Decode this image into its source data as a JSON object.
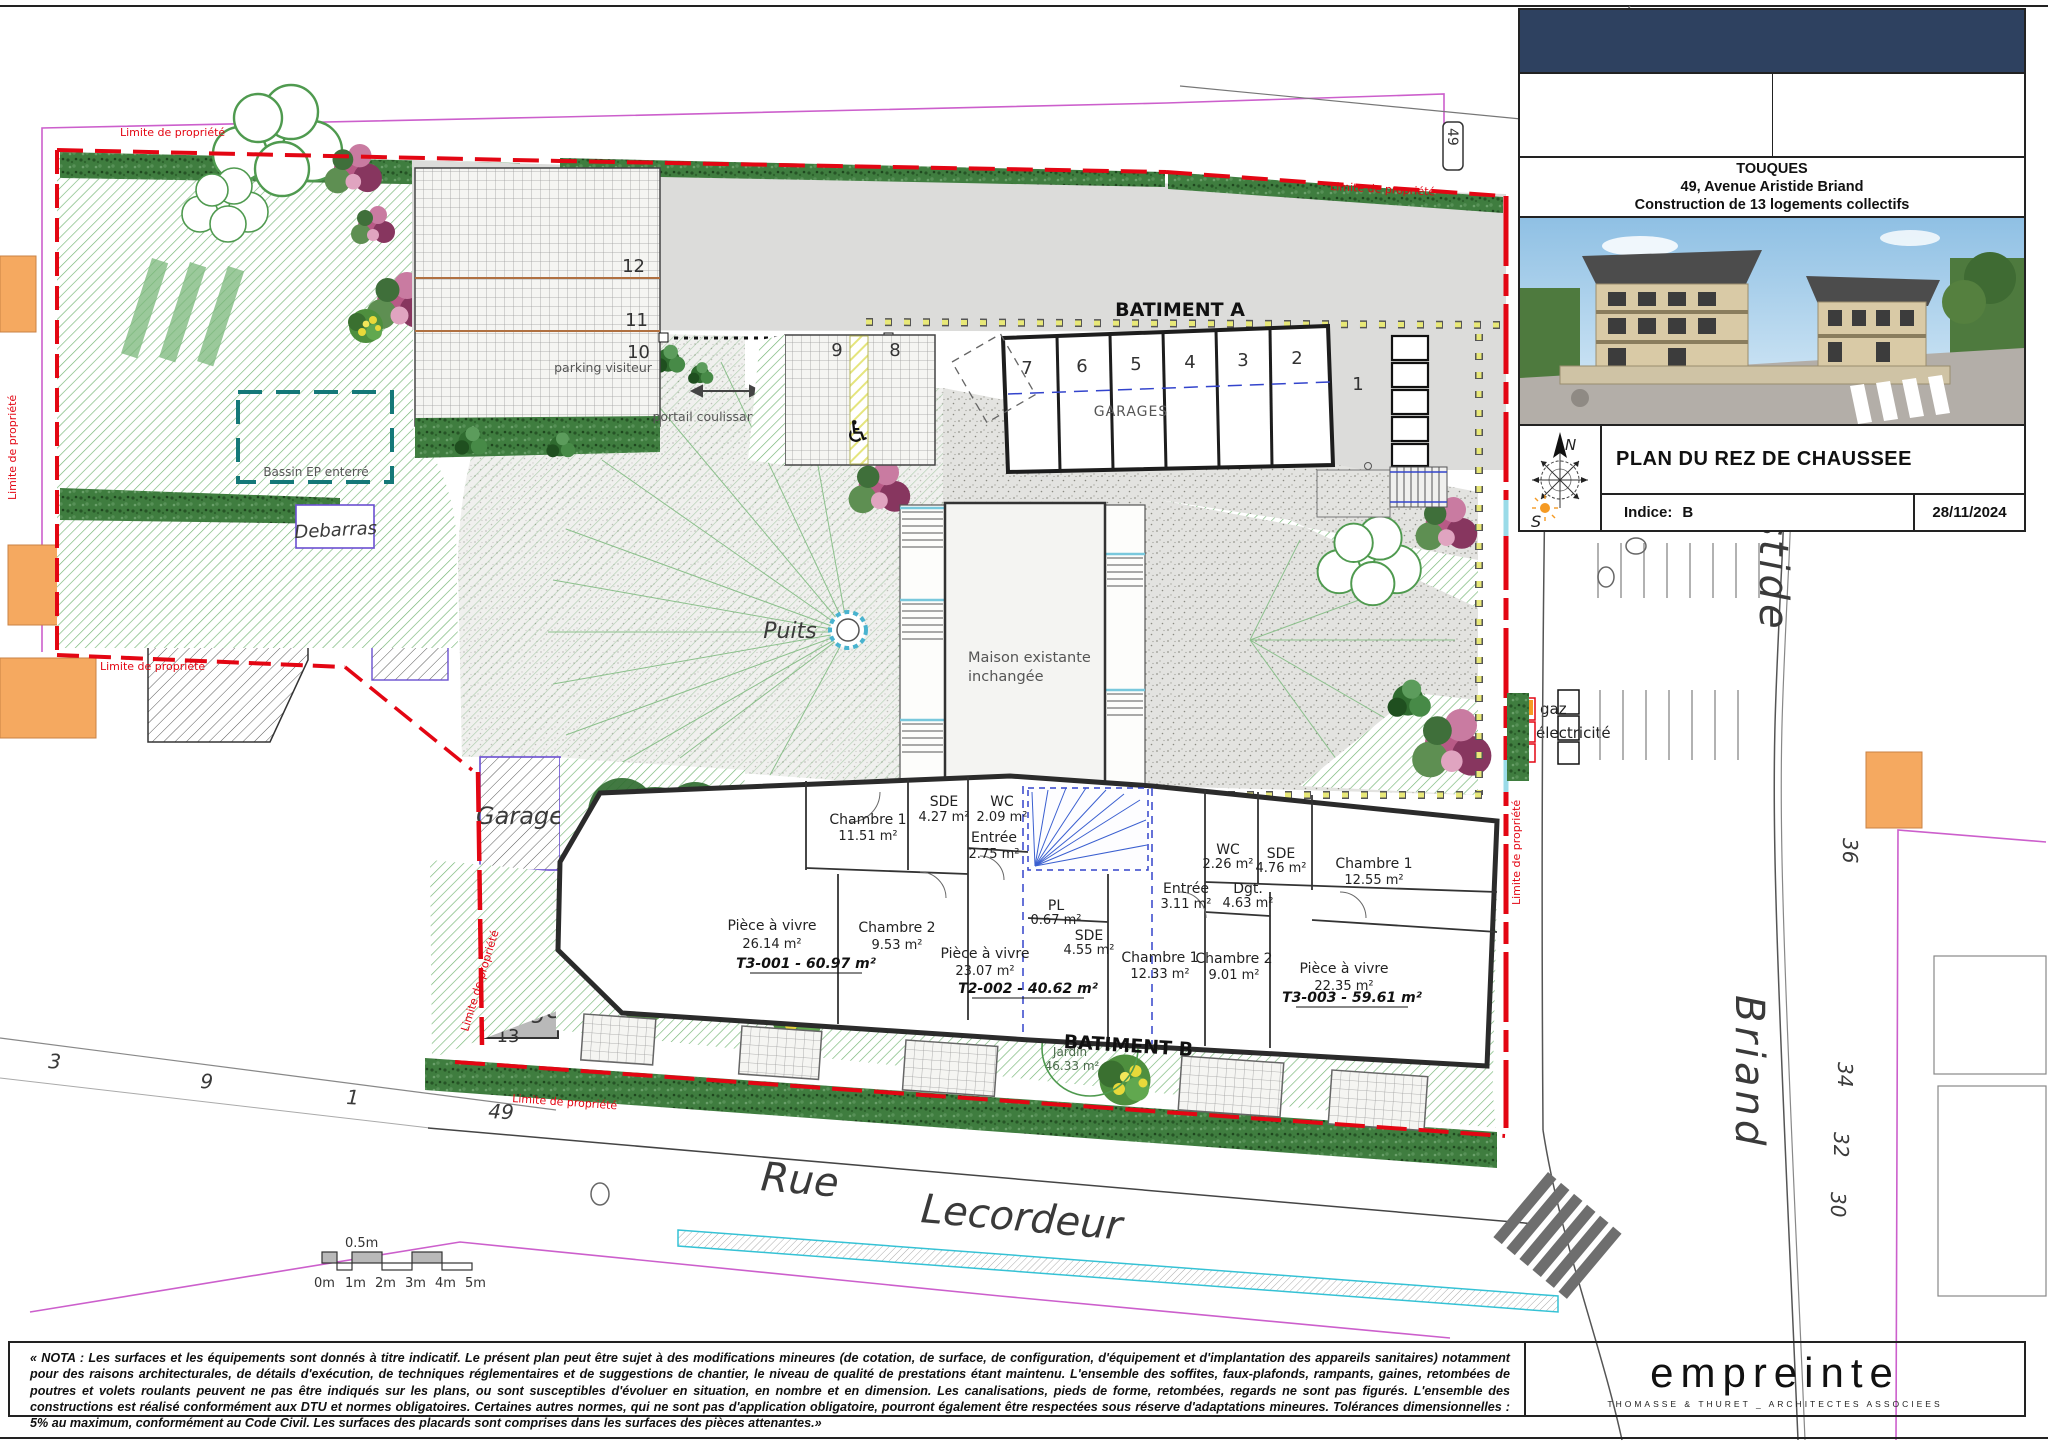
{
  "title_block": {
    "city": "TOUQUES",
    "address": "49, Avenue Aristide Briand",
    "project": "Construction de 13 logements collectifs",
    "drawing_title": "PLAN DU REZ DE CHAUSSEE",
    "indice_label": "Indice:",
    "indice_value": "B",
    "date": "28/11/2024",
    "compass_n": "N",
    "compass_s": "S"
  },
  "architect": {
    "logo": "empreinte",
    "subtitle": "THOMASSE & THURET _ ARCHITECTES ASSOCIEES"
  },
  "nota": "« NOTA : Les surfaces et les équipements sont donnés à titre indicatif. Le présent plan peut être sujet à des modifications mineures (de cotation, de surface, de configuration, d'équipement et d'implantation des appareils sanitaires) notamment pour des raisons architecturales, de détails d'exécution, de techniques réglementaires et de suggestions de chantier, le niveau de qualité de prestations étant maintenu. L'ensemble des soffites, faux-plafonds, rampants, gaines, retombées de poutres et volets roulants peuvent ne pas être indiqués sur les plans, ou sont susceptibles d'évoluer en situation, en nombre et en dimension. Les canalisations, pieds de forme, retombées, regards ne sont pas figurés. L'ensemble des constructions est réalisé conformément aux DTU et normes obligatoires. Certaines autres normes, qui ne sont pas d'application obligatoire, pourront également être respectées sous réserve d'adaptations mineures. Tolérances dimensionnelles : 5% au maximum, conformément au Code Civil. Les surfaces des placards sont comprises dans les surfaces des pièces attenantes.»",
  "plan": {
    "limite": "Limite de propriété",
    "batiment_a": {
      "label": "BATIMENT A",
      "garages_label": "GARAGES",
      "garage_numbers": [
        "7",
        "6",
        "5",
        "4",
        "3",
        "2"
      ],
      "space_1": "1",
      "space_9": "9",
      "space_8": "8",
      "visitor_label": "parking visiteur",
      "visitor_numbers": [
        "12",
        "11",
        "10"
      ],
      "portail": "portail coulissant"
    },
    "maison": {
      "line1": "Maison existante",
      "line2": "inchangée"
    },
    "puits": "Puits",
    "bassin": "Bassin EP enterré",
    "debarras": "Debarras",
    "garage_word": "Garage",
    "garage_13": "13",
    "magnolia": {
      "line1": "Magnolia",
      "line2": "existant",
      "line3": "conservé"
    },
    "jardin_word": "Jardin",
    "jardin_areas": [
      "110.52 m²",
      "46.33 m²",
      "101.31 m²"
    ],
    "gaz": "gaz",
    "electricite": "électricité",
    "batiment_b": {
      "label": "BATIMENT B",
      "t3_001": {
        "chambre1": {
          "name": "Chambre 1",
          "area": "11.51 m²"
        },
        "sde": {
          "name": "SDE",
          "area": "4.27 m²"
        },
        "wc": {
          "name": "WC",
          "area": "2.09 m²"
        },
        "entree": {
          "name": "Entrée",
          "area": "2.75 m²"
        },
        "piece": {
          "name": "Pièce à vivre",
          "area": "26.14 m²"
        },
        "chambre2": {
          "name": "Chambre 2",
          "area": "9.53 m²"
        },
        "total": "T3-001 - 60.97 m²"
      },
      "t2_002": {
        "piece": {
          "name": "Pièce à vivre",
          "area": "23.07 m²"
        },
        "pl": {
          "name": "PL",
          "area": "0.67 m²"
        },
        "sde": {
          "name": "SDE",
          "area": "4.55 m²"
        },
        "chambre1": {
          "name": "Chambre 1",
          "area": "12.33 m²"
        },
        "total": "T2-002 - 40.62 m²"
      },
      "t3_003": {
        "entree": {
          "name": "Entrée",
          "area": "3.11 m²"
        },
        "wc": {
          "name": "WC",
          "area": "2.26 m²"
        },
        "sde": {
          "name": "SDE",
          "area": "4.76 m²"
        },
        "dgt": {
          "name": "Dgt.",
          "area": "4.63 m²"
        },
        "chambre1": {
          "name": "Chambre 1",
          "area": "12.55 m²"
        },
        "chambre2": {
          "name": "Chambre 2",
          "area": "9.01 m²"
        },
        "piece": {
          "name": "Pièce à vivre",
          "area": "22.35 m²"
        },
        "total": "T3-003 - 59.61 m²"
      }
    },
    "streets": {
      "rue": "Rue",
      "lecordeur": "Lecordeur",
      "aristide": "Aristide",
      "briand": "Briand"
    },
    "numbers_left": [
      "3",
      "9",
      "1",
      "49"
    ],
    "numbers_right": [
      "36",
      "34",
      "32",
      "30"
    ],
    "sign_49": "49",
    "scale": {
      "half": "0.5m",
      "ticks": [
        "0m",
        "1m",
        "2m",
        "3m",
        "4m",
        "5m"
      ]
    }
  }
}
